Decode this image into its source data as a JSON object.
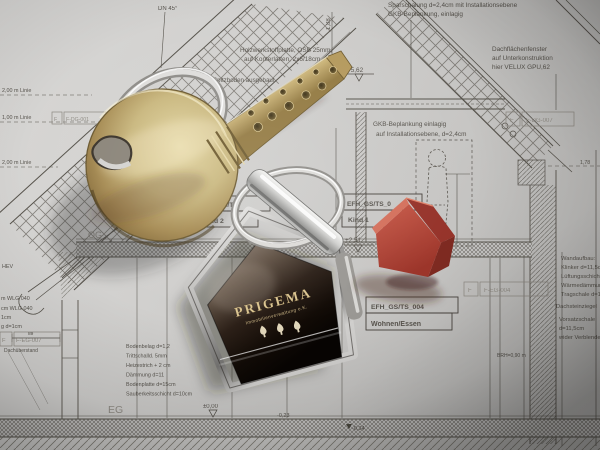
{
  "bp": {
    "dn45": "DN 45°",
    "note_sparschalung": "Sparschalung d=2,4cm mit Installationsebene",
    "note_gkb_top": "GKB-Beplankung, einlagig",
    "note_osb_1": "Holzwerkstoffplatte, OSB 25mm,",
    "note_osb_2": "auf Konterlatten, 2x6/18cm",
    "note_spitzboden": "Spitzboden ausgebaut",
    "note_fenster_1": "Dachflächenfenster",
    "note_fenster_2": "auf Unterkonstruktion",
    "note_fenster_3": "hier VELUX GPU,62",
    "note_gkb_mid_1": "GKB-Beplankung einlagig",
    "note_gkb_mid_2": "auf Installationsebene, d=2,4cm",
    "dim_188": "1,88",
    "dim_178": "1,78",
    "dim_89": "89",
    "elev_562": "+5,62",
    "elev_251": "+2,51",
    "elev_000": "±0,00",
    "elev_m023": "-0,23",
    "elev_m034": "-0,34",
    "linie_200_a": "2,00 m Linie",
    "linie_100": "1,00 m Linie",
    "linie_200_b": "2,00 m Linie",
    "og": "OG",
    "eg": "EG",
    "room1_id": "EFH_GS/TS",
    "room1_name": "Kind 2",
    "room2_id": "EFH_GS/TS_0",
    "room2_name": "Kind 1",
    "room3_id": "EFH_GS/TS_004",
    "room3_name": "Wohnen/Essen",
    "ref_f": "F",
    "ref_dg007": "F-DG-007",
    "ref_eg004": "F-EG-004",
    "ref_eg007": "F-EG-007",
    "ref_dg001": "F-DG-001",
    "wall_layers": [
      "Wandaufbau:",
      "Klinker d=11,5cm",
      "Lüftungsschicht",
      "Wärmedämmung",
      "Tragschale d=17,5"
    ],
    "right_notes": [
      "Dachsteinziegel",
      "Vorsatzschale",
      "d=11,5cm",
      "wider Verblender"
    ],
    "brh": "BRH=0,90 m",
    "left_fragments": [
      "HEV",
      "m WLG 040",
      "cm WLG 040",
      "1cm",
      "g d=1cm"
    ],
    "dachueberstand": "Dachüberstand",
    "floor_layers": [
      "Bodenbelag d=1,2",
      "Trittschalld. 5mm",
      "Heizestrich + 2 cm",
      "Dämmung d=11",
      "Bodenplatte d=15cm",
      "Sauberkeitsschicht d=10cm"
    ],
    "note_nutzung": "bei Nutzung, Abdichtung"
  },
  "keychain": {
    "brand": "PRIGEMA",
    "subtitle": "Immobilienverwaltung e.K.",
    "icon": "three-trees-icon"
  },
  "colors": {
    "paper": "#cccbc9",
    "ink": "#4c4841",
    "brass": "#c3ac72",
    "silver": "#d9d9d7",
    "fob_face": "#14100c",
    "fob_gold": "#d9c18c",
    "red_house": "#b5453a"
  }
}
